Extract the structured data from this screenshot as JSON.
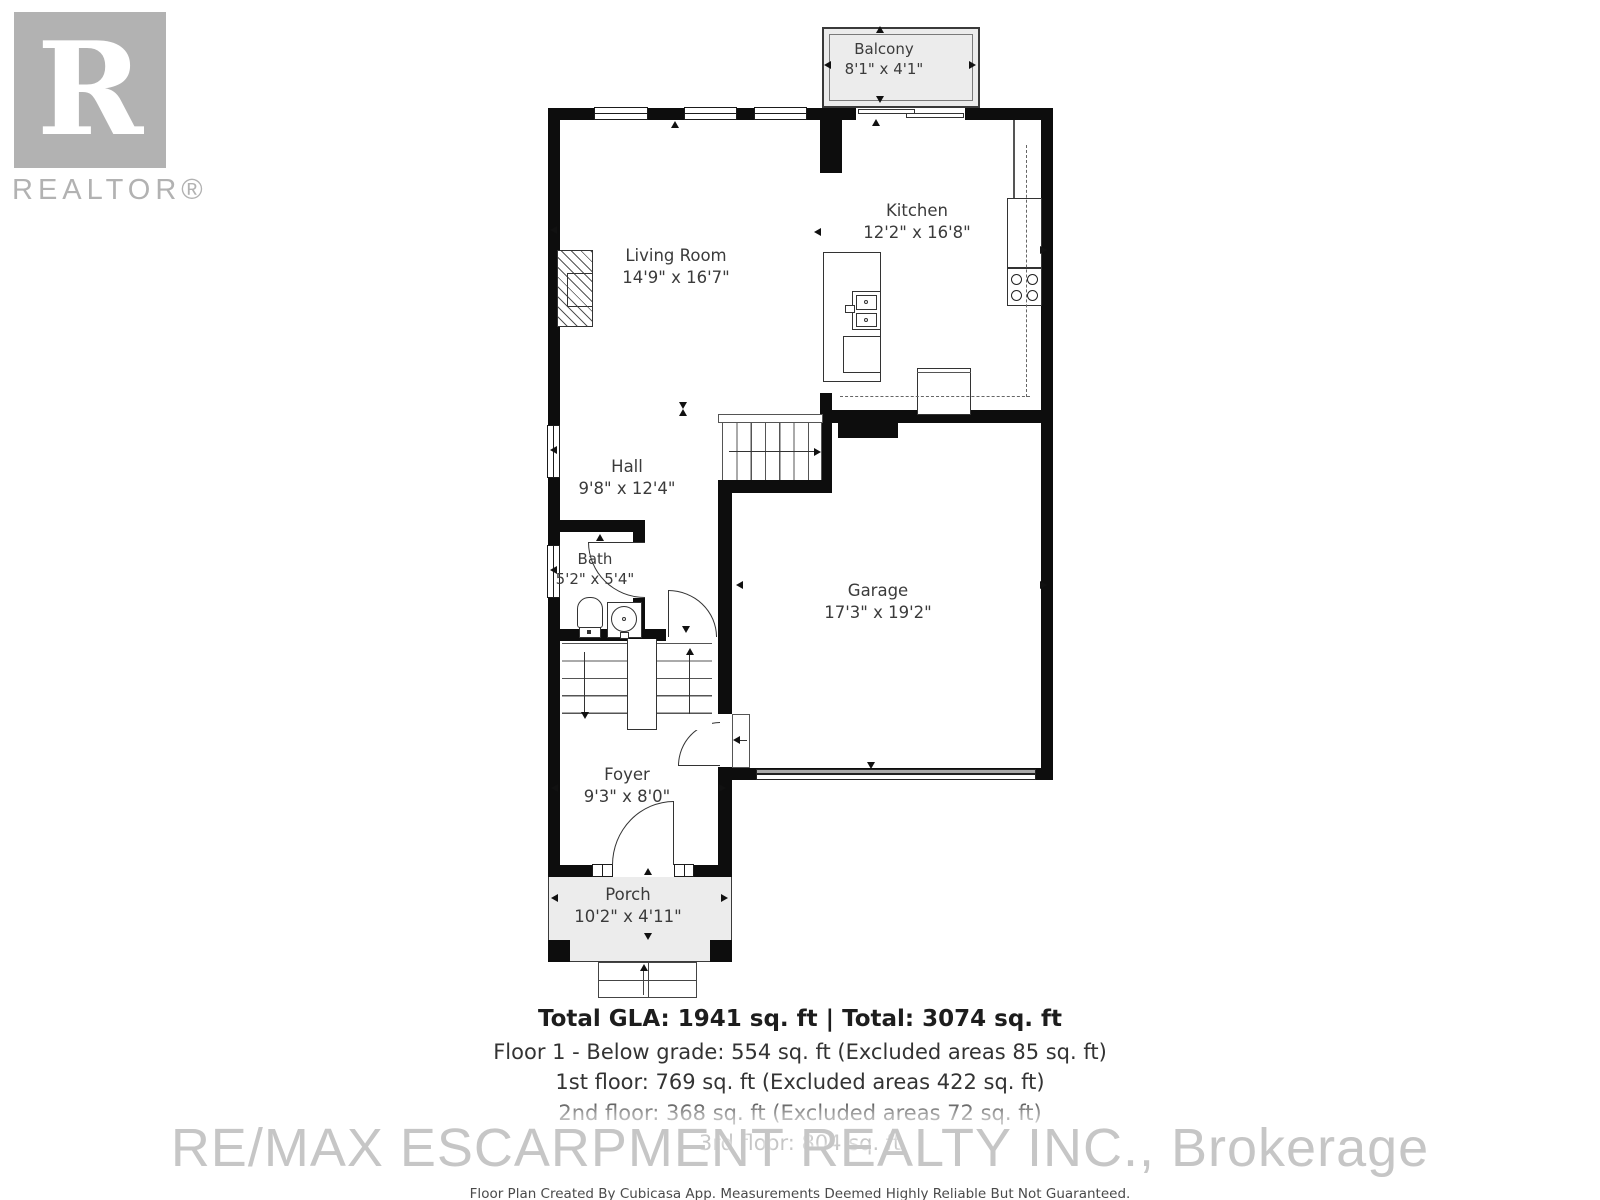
{
  "logo": {
    "letter": "R",
    "label": "REALTOR®"
  },
  "rooms": {
    "balcony": {
      "name": "Balcony",
      "dims": "8'1\" x 4'1\""
    },
    "kitchen": {
      "name": "Kitchen",
      "dims": "12'2\" x 16'8\""
    },
    "living_room": {
      "name": "Living Room",
      "dims": "14'9\" x 16'7\""
    },
    "hall": {
      "name": "Hall",
      "dims": "9'8\" x 12'4\""
    },
    "bath": {
      "name": "Bath",
      "dims": "5'2\" x 5'4\""
    },
    "garage": {
      "name": "Garage",
      "dims": "17'3\" x 19'2\""
    },
    "foyer": {
      "name": "Foyer",
      "dims": "9'3\" x 8'0\""
    },
    "porch": {
      "name": "Porch",
      "dims": "10'2\" x 4'11\""
    }
  },
  "summary": {
    "title": "Total GLA: 1941 sq. ft | Total: 3074 sq. ft",
    "lines": [
      "Floor 1 - Below grade: 554 sq. ft (Excluded areas 85 sq. ft)",
      "1st floor: 769 sq. ft (Excluded areas 422 sq. ft)",
      "2nd floor: 368 sq. ft (Excluded areas 72 sq. ft)",
      "3rd floor: 804 sq. ft"
    ]
  },
  "watermark": {
    "brokerage": "RE/MAX ESCARPMENT REALTY INC., Brokerage"
  },
  "disclaimer": "Floor Plan Created By Cubicasa App. Measurements Deemed Highly Reliable But Not Guaranteed.",
  "colors": {
    "wall": "#0d0d0d",
    "area_fill": "#ececec",
    "watermark_gray": "#c6c6c6"
  }
}
